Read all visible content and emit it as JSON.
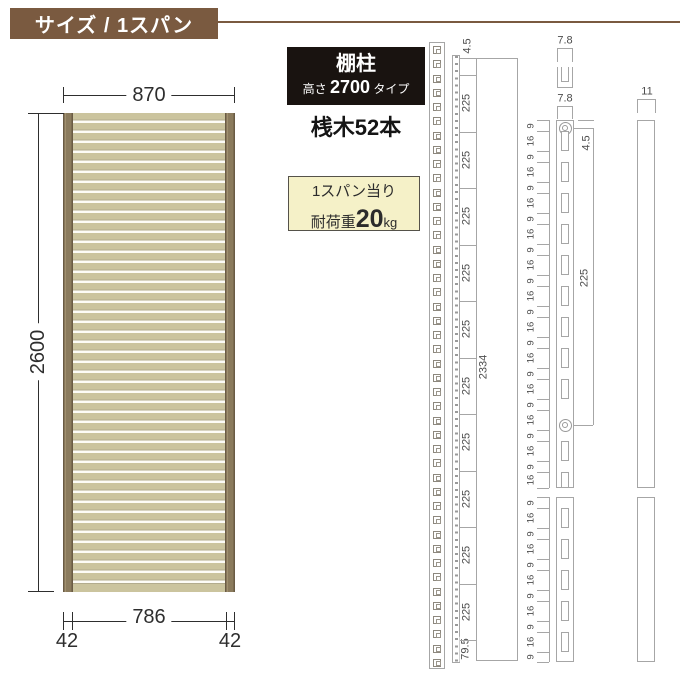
{
  "header": {
    "title": "サイズ / 1スパン"
  },
  "colors": {
    "accent_brown": "#7a5a40",
    "slat": "#cbc49e",
    "slat_edge": "#b3ac8d",
    "gap_white": "#fdfcf6",
    "post_mid": "#8b7b5d",
    "post_light": "#a1906f",
    "post_dark": "#6a5b44",
    "black_box_bg": "#191310",
    "load_bg": "#f5f1c8",
    "load_border": "#55524a",
    "draw_line": "#a6a6a6",
    "draw_text": "#4c4c4c",
    "dim_dark": "#2e2e2e"
  },
  "panel": {
    "dim_top": "870",
    "dim_left": "2600",
    "dim_bottom_inner": "786",
    "dim_bottom_left": "42",
    "dim_bottom_right": "42"
  },
  "labels": {
    "column_title": "棚柱",
    "column_subtitle_prefix": "高さ ",
    "column_subtitle_value": "2700",
    "column_subtitle_suffix": " タイプ",
    "crosspieces": "桟木52本",
    "load_line1": "1スパン当り",
    "load_prefix": "耐荷重",
    "load_value": "20",
    "load_unit": "kg"
  },
  "drawing_full": {
    "dim_top": "4.5",
    "dim_pitch": "225",
    "pitch_count": 10,
    "dim_bottom": "79.5",
    "dim_total": "2334"
  },
  "drawing_detail": {
    "dim_section_width": "7.8",
    "dim_front_width": "7.8",
    "dim_side_width": "11",
    "dim_hole_offset": "4.5",
    "dim_hole_pitch": "225",
    "dim_slot": "16",
    "dim_gap": "9"
  }
}
